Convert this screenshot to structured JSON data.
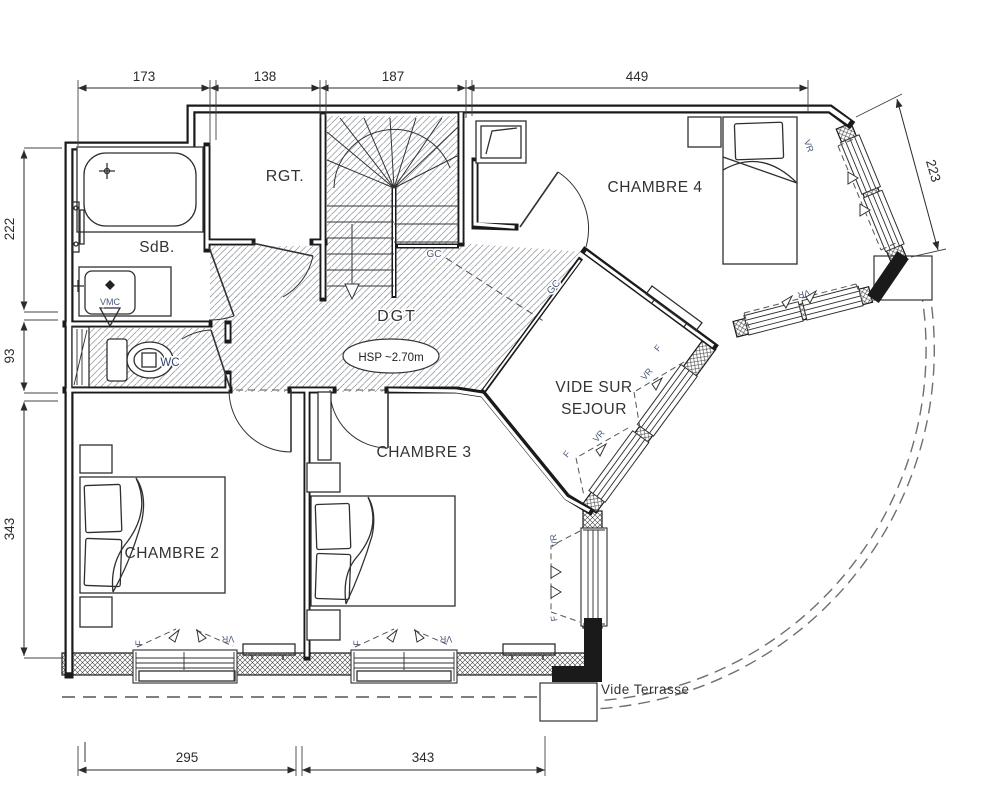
{
  "dimensions": {
    "top": [
      "173",
      "138",
      "187",
      "449"
    ],
    "left": [
      "222",
      "93",
      "343"
    ],
    "right": "223",
    "bottom": [
      "295",
      "343"
    ]
  },
  "rooms": {
    "sdb": "SdB.",
    "rgt": "RGT.",
    "wc": "WC",
    "dgt": "DGT",
    "chambre2": "CHAMBRE 2",
    "chambre3": "CHAMBRE 3",
    "chambre4": "CHAMBRE 4",
    "vide_sejour_line1": "VIDE SUR",
    "vide_sejour_line2": "SEJOUR",
    "vide_terrasse": "Vide Terrasse"
  },
  "annotations": {
    "hsp": "HSP ~2.70m",
    "gc": "GC",
    "vr": "VR",
    "f": "F",
    "vmc": "VMC"
  },
  "colors": {
    "wall": "#1a1a1a",
    "hatch": "#8a8f99",
    "label": "#333333",
    "small_label": "#4a5a7a",
    "dim": "#2b2b2b"
  }
}
